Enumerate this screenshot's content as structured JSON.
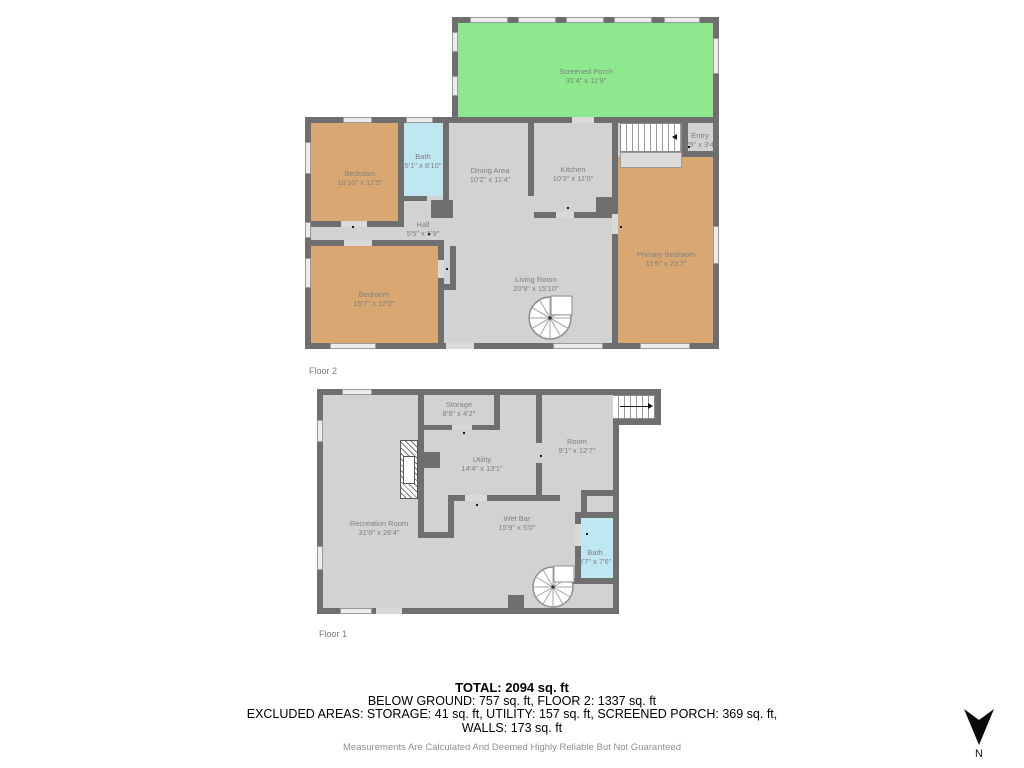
{
  "colors": {
    "wall": "#6f6f6f",
    "floor": "#d2d2d2",
    "porch": "#8ee88e",
    "bedroom": "#d9a772",
    "bath": "#bfe7f1",
    "label": "#7f7f7f"
  },
  "floor2": {
    "label": "Floor 2",
    "rooms": {
      "screened_porch": {
        "name": "Screened Porch",
        "dims": "31'4\" x 11'9\""
      },
      "bedroom_top": {
        "name": "Bedroom",
        "dims": "10'10\" x 12'5\""
      },
      "bath": {
        "name": "Bath",
        "dims": "5'1\" x 8'10\""
      },
      "dining_area": {
        "name": "Dining Area",
        "dims": "10'2\" x 11'4\""
      },
      "kitchen": {
        "name": "Kitchen",
        "dims": "10'3\" x 11'0\""
      },
      "entry": {
        "name": "Entry",
        "dims": "3'5\" x 3'4\""
      },
      "hall": {
        "name": "Hall",
        "dims": "5'5\" x 5'9\""
      },
      "primary_bedroom": {
        "name": "Primary Bedroom",
        "dims": "11'6\" x 23'7\""
      },
      "bedroom_bottom": {
        "name": "Bedroom",
        "dims": "15'7\" x 12'0\""
      },
      "living_room": {
        "name": "Living Room",
        "dims": "20'9\" x 15'10\""
      }
    }
  },
  "floor1": {
    "label": "Floor 1",
    "rooms": {
      "storage": {
        "name": "Storage",
        "dims": "8'9\" x 4'2\""
      },
      "room": {
        "name": "Room",
        "dims": "9'1\" x 12'7\""
      },
      "utility": {
        "name": "Utility",
        "dims": "14'4\" x 13'1\""
      },
      "recreation_room": {
        "name": "Recreation Room",
        "dims": "31'0\" x 26'4\""
      },
      "wet_bar": {
        "name": "Wet Bar",
        "dims": "15'9\" x 5'0\""
      },
      "bath": {
        "name": "Bath",
        "dims": "3'7\" x 7'6\""
      }
    }
  },
  "summary": {
    "total": "TOTAL: 2094 sq. ft",
    "line2": "BELOW GROUND: 757 sq. ft, FLOOR 2: 1337 sq. ft",
    "line3": "EXCLUDED AREAS: STORAGE: 41 sq. ft, UTILITY: 157 sq. ft, SCREENED PORCH: 369 sq. ft,",
    "line4": "WALLS: 173 sq. ft",
    "disclaimer": "Measurements Are Calculated And Deemed Highly Reliable But Not Guaranteed"
  },
  "compass": {
    "label": "N"
  }
}
